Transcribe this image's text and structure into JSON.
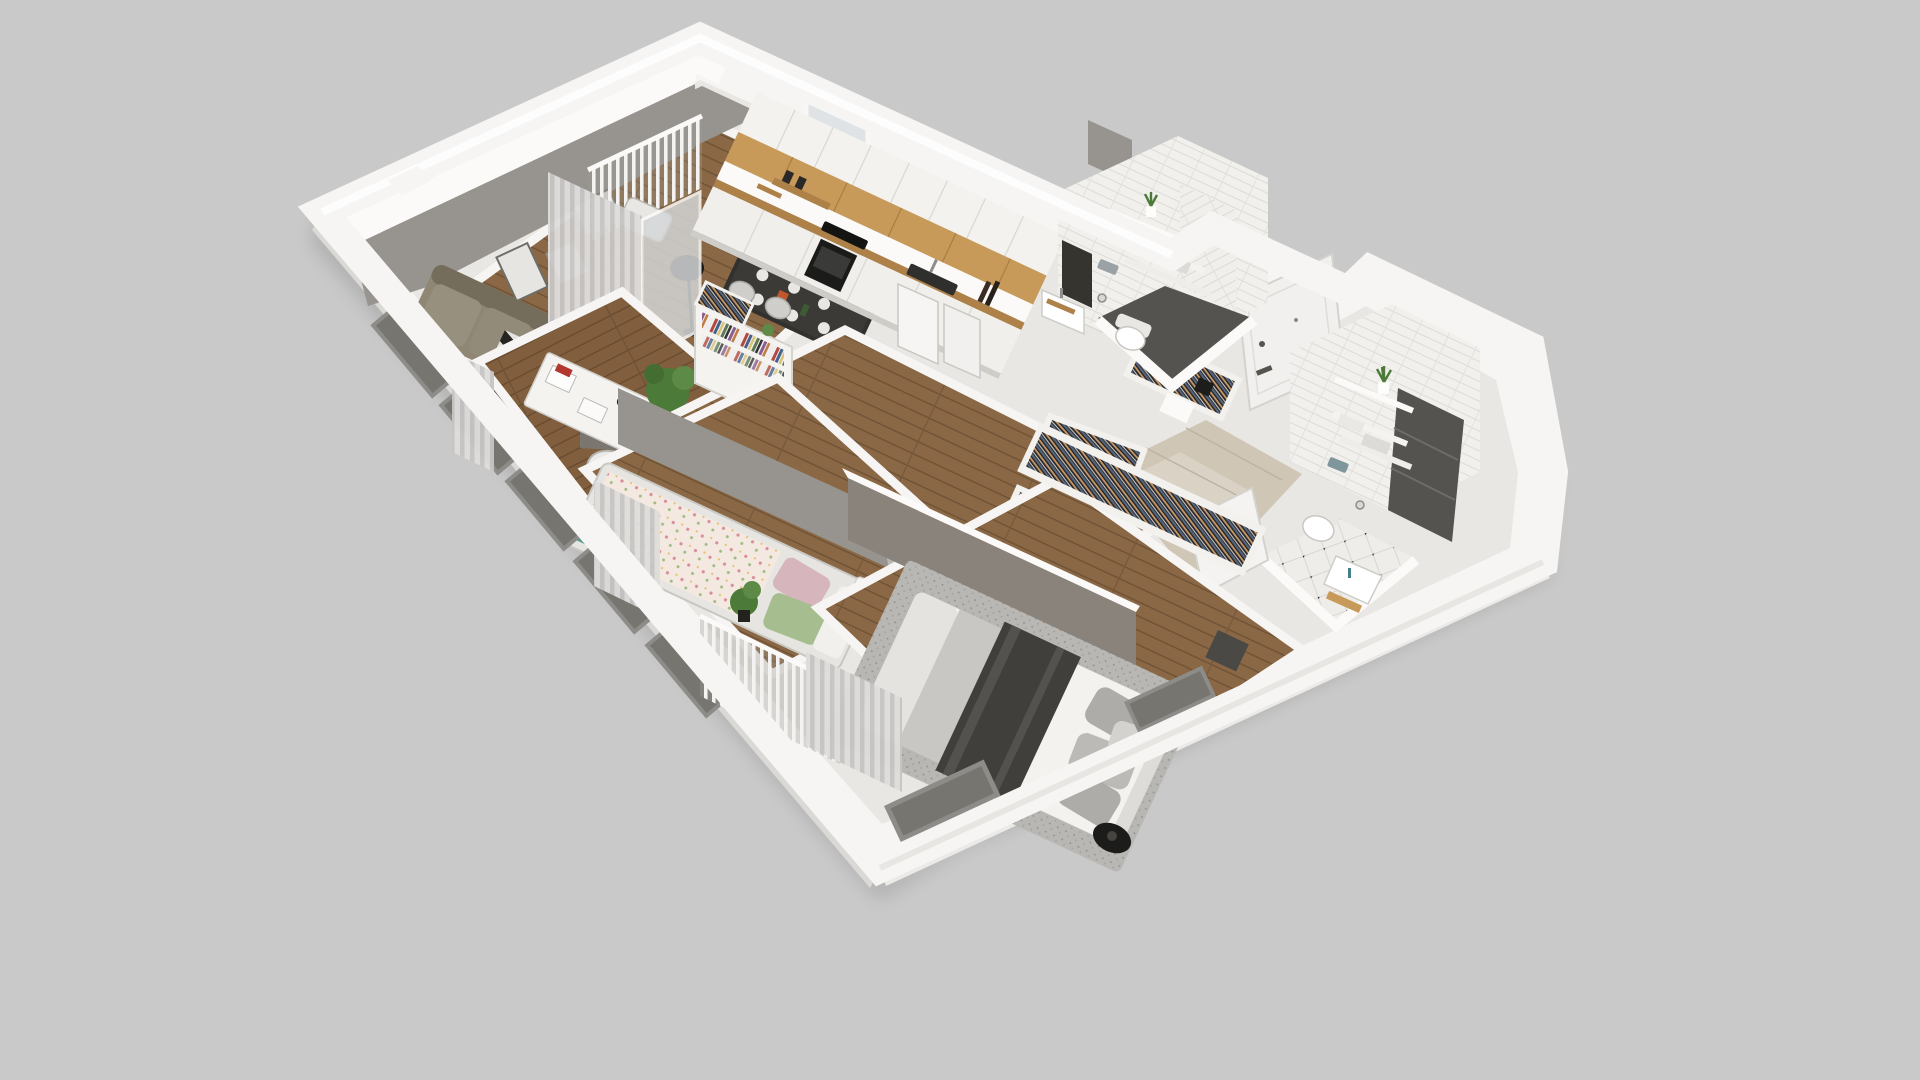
{
  "scene": {
    "kind": "isometric-dollhouse-floorplan-render",
    "view_angle": "top-down-oblique",
    "no_visible_text": true,
    "background": "#c9c9c9"
  },
  "palette": {
    "bg": "#c9c9c9",
    "shadow": "#b2b2b2",
    "wallWhite": "#f6f5f3",
    "wallLight": "#eceae7",
    "wallShade": "#dbd9d5",
    "floorBase": "#e9e7e3",
    "innerGray": "#97948f",
    "innerGrayDark": "#7b7974",
    "taupeWall": "#8a837c",
    "wood": "#8a6845",
    "woodDark": "#73543a",
    "oak": "#c79a5a",
    "oakDark": "#ad8148",
    "tileWhite": "#f1f0ed",
    "graphite": "#55534f",
    "graphiteDark": "#35342f",
    "beigeTile": "#cfc6b5",
    "sofa": "#8f8674",
    "sofaDark": "#756d5c",
    "black": "#1e1d1b",
    "rugGray": "#b9b7b3",
    "bedWhite": "#f3f2ef",
    "throwDark": "#413f3c",
    "pillowGray": "#aeaca8",
    "pink": "#d6b5bc",
    "green": "#a5bd8f",
    "floralBase": "#f4e9e1",
    "teal": "#3e8c84",
    "plant": "#4c7a38",
    "doorWhite": "#f1f0ee",
    "curtain": "#d9d8d6",
    "chairWhite": "#e8e7e4",
    "metal": "#8f8e8c"
  },
  "apartment": {
    "label": "3-room apartment 3D plan",
    "rooms": [
      {
        "id": "living-dining",
        "label": "living-dining-room",
        "floor": "wood",
        "items": [
          "sofa",
          "striped-rug",
          "coffee-table",
          "wall-art-frames",
          "floor-lamp",
          "dining-table",
          "dining-chairs",
          "potted-plant",
          "curtains",
          "balcony-door"
        ]
      },
      {
        "id": "balcony",
        "label": "balcony",
        "floor": "concrete",
        "items": [
          "railing",
          "lounge-chair",
          "cushion"
        ]
      },
      {
        "id": "kitchen",
        "label": "kitchen",
        "floor": "wood",
        "items": [
          "white-cabinets",
          "oak-backsplash",
          "wood-countertop",
          "oven",
          "cooktop",
          "sink",
          "faucet",
          "bottles",
          "window"
        ]
      },
      {
        "id": "office",
        "label": "office-nook",
        "floor": "wood",
        "items": [
          "white-desk",
          "shell-chair",
          "desk-lamp",
          "books",
          "potted-plant",
          "gray-accent-wall"
        ]
      },
      {
        "id": "kids-room",
        "label": "kids-bedroom",
        "floor": "wood",
        "items": [
          "single-bed",
          "floral-duvet",
          "pink-pillow",
          "green-pillow",
          "round-rug",
          "play-table",
          "dinosaur-toy",
          "curtains"
        ]
      },
      {
        "id": "master-bedroom",
        "label": "master-bedroom",
        "floor": "wood",
        "items": [
          "double-bed",
          "dark-throw",
          "gray-pillows",
          "area-rug",
          "wall-tv",
          "open-closet-hangers",
          "balcony-door",
          "plant",
          "table-lamp"
        ]
      },
      {
        "id": "hallway",
        "label": "entry-hall",
        "floor": "beige-gloss-tile",
        "items": [
          "front-door",
          "open-wardrobes-with-clothes",
          "bookcase",
          "white-doors"
        ]
      },
      {
        "id": "bathroom-a",
        "label": "wc",
        "floor": "graphite-tile",
        "items": [
          "wall-hung-toilet",
          "flush-plate",
          "toilet-paper-holder",
          "washbasin",
          "wood-tray",
          "shelves",
          "towels",
          "potted-plant",
          "dark-niche",
          "subway-tiles"
        ]
      },
      {
        "id": "bathroom-b",
        "label": "bathroom",
        "floor": "white-tile-black-dots",
        "items": [
          "wall-hung-toilet",
          "flush-plate",
          "toilet-paper-holder",
          "washbasin",
          "faucet",
          "shelves",
          "towels",
          "potted-plant",
          "graphite-accent-panel",
          "wood-mat",
          "subway-tiles"
        ]
      }
    ],
    "exterior": [
      "thick-white-cut-walls",
      "gray-window-slabs",
      "balcony-railings",
      "soft-drop-shadow"
    ]
  }
}
